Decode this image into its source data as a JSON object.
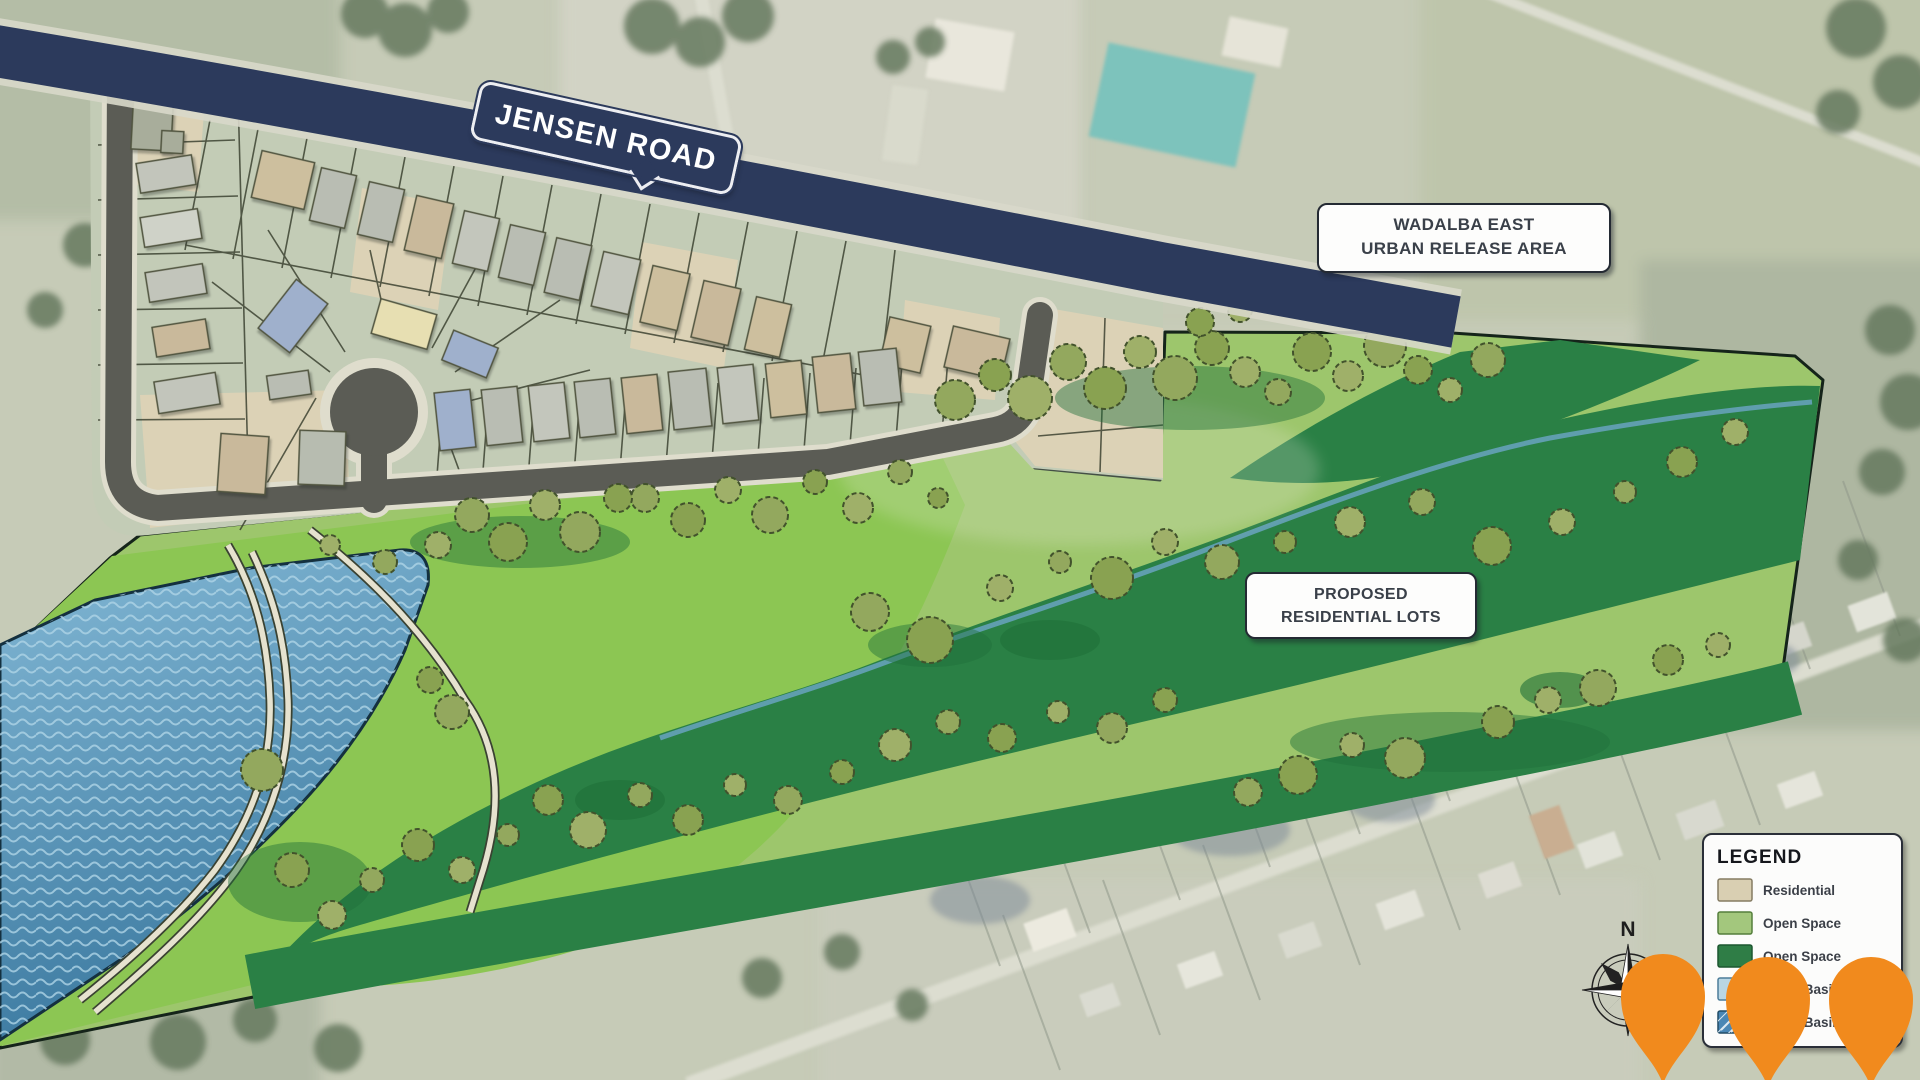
{
  "map": {
    "road_label": "JENSEN ROAD",
    "area_label": {
      "line1": "WADALBA EAST",
      "line2": "URBAN RELEASE AREA"
    },
    "proposed_label": {
      "line1": "PROPOSED",
      "line2": "RESIDENTIAL LOTS"
    }
  },
  "legend": {
    "title": "LEGEND",
    "items": [
      {
        "label": "Residential",
        "color": "#d9cfb2",
        "border": "#857c63"
      },
      {
        "label": "Open Space",
        "color": "#a3c77d",
        "border": "#557f3c"
      },
      {
        "label": "Open Space",
        "color": "#2f7d46",
        "border": "#1d5630"
      },
      {
        "label": "Water Basin",
        "color": "#b9d6e4",
        "border": "#4d7d99"
      },
      {
        "label": "Water Basin",
        "color": "#4a87b5",
        "border": "#234d66"
      }
    ]
  },
  "compass": {
    "north_label": "N"
  },
  "markers": {
    "pin_color": "#f18a1d",
    "count": 3
  },
  "colors": {
    "jensen_road": "#2c3a5c",
    "open_space_light": "#9dc66c",
    "open_space_bright": "#8cc653",
    "open_space_dark": "#2a8045",
    "water_top": "#84b9d6",
    "water_bottom": "#3a789f",
    "residential_lot": "#dcd2b6",
    "estate_ground": "#c3ccb6",
    "internal_road": "#5b5c55",
    "aerial_base": "#c6cbb7"
  }
}
